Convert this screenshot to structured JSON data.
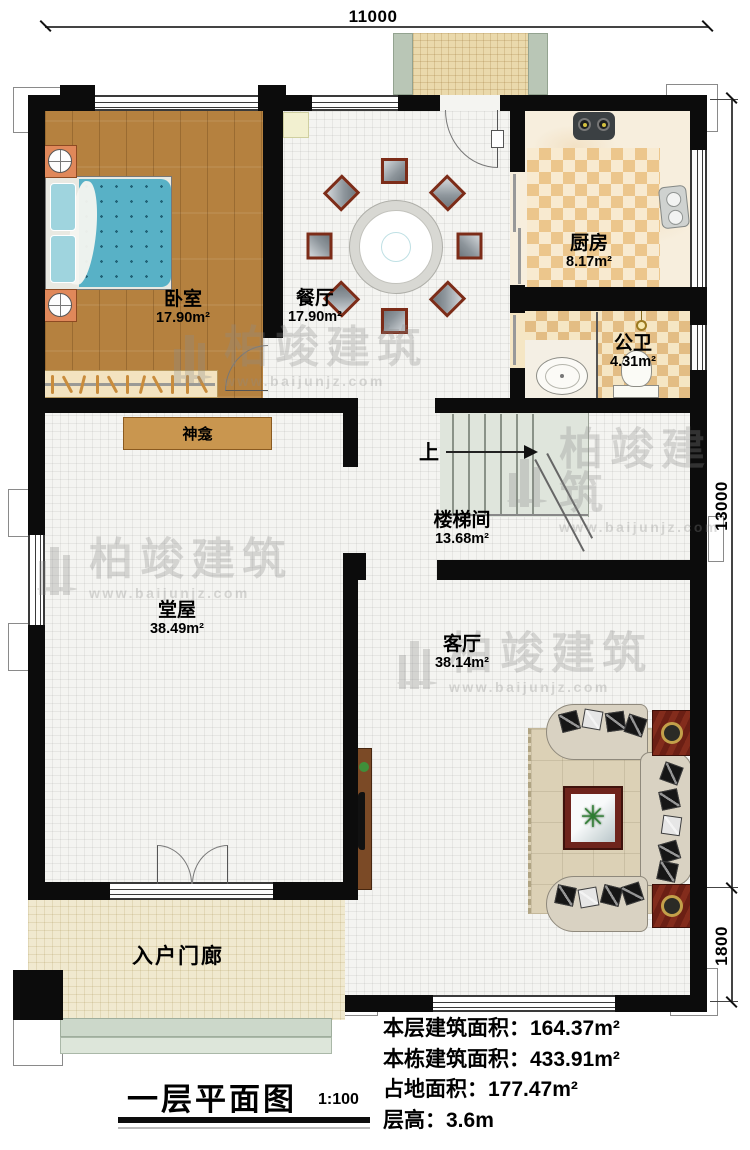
{
  "meta": {
    "title": "一层平面图",
    "scale": "1:100"
  },
  "dimensions": {
    "top": "11000",
    "right_main": "13000",
    "right_bottom": "1800"
  },
  "rooms": [
    {
      "id": "bedroom",
      "name": "卧室",
      "area": "17.90m²"
    },
    {
      "id": "dining",
      "name": "餐厅",
      "area": "17.90m²"
    },
    {
      "id": "kitchen",
      "name": "厨房",
      "area": "8.17m²"
    },
    {
      "id": "bathroom",
      "name": "公卫",
      "area": "4.31m²"
    },
    {
      "id": "stairwell",
      "name": "楼梯间",
      "area": "13.68m²"
    },
    {
      "id": "hall",
      "name": "堂屋",
      "area": "38.49m²"
    },
    {
      "id": "living",
      "name": "客厅",
      "area": "38.14m²"
    },
    {
      "id": "porch",
      "name": "入户门廊"
    }
  ],
  "labels": {
    "shrine": "神龛",
    "stairs_up": "上"
  },
  "stats": [
    {
      "text": "本层建筑面积：164.37m²"
    },
    {
      "text": "本栋建筑面积：433.91m²"
    },
    {
      "text": "占地面积：177.47m²"
    },
    {
      "text": "层高：3.6m"
    }
  ],
  "watermark": {
    "name": "柏竣建筑",
    "url": "www.baijunjz.com"
  },
  "colors": {
    "wall": "#0c0c0c",
    "wood_floor": "#b5813f",
    "checker": "#e3bd84",
    "shrine": "#c9964f",
    "sofa": "#d9d2c2",
    "table_wood": "#6e241c",
    "bed_blanket": "#58b1c6",
    "stairs": "#dfe5dc"
  }
}
